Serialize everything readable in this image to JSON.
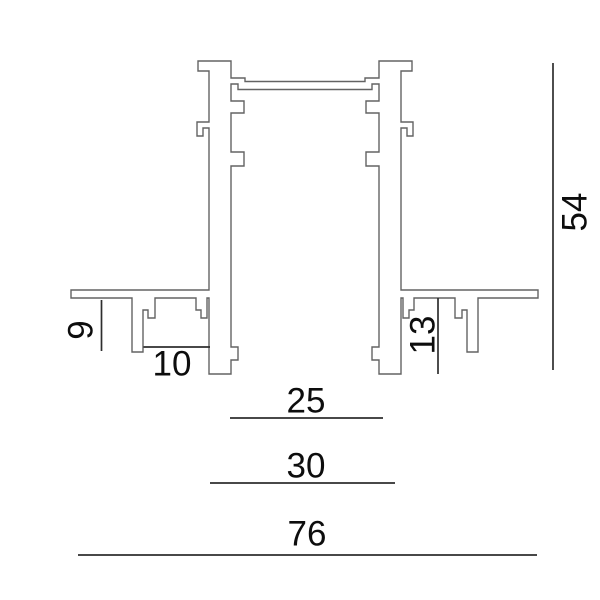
{
  "diagram": {
    "description": "Cross-section technical drawing of a recessed aluminium track profile with dimension annotations"
  },
  "dims": {
    "d9": "9",
    "d10": "10",
    "d13": "13",
    "d25": "25",
    "d30": "30",
    "d54": "54",
    "d76": "76"
  },
  "colors": {
    "outline": "#636363",
    "dimension": "#2e2e2e",
    "text": "#0d0d0d",
    "background": "#ffffff"
  }
}
